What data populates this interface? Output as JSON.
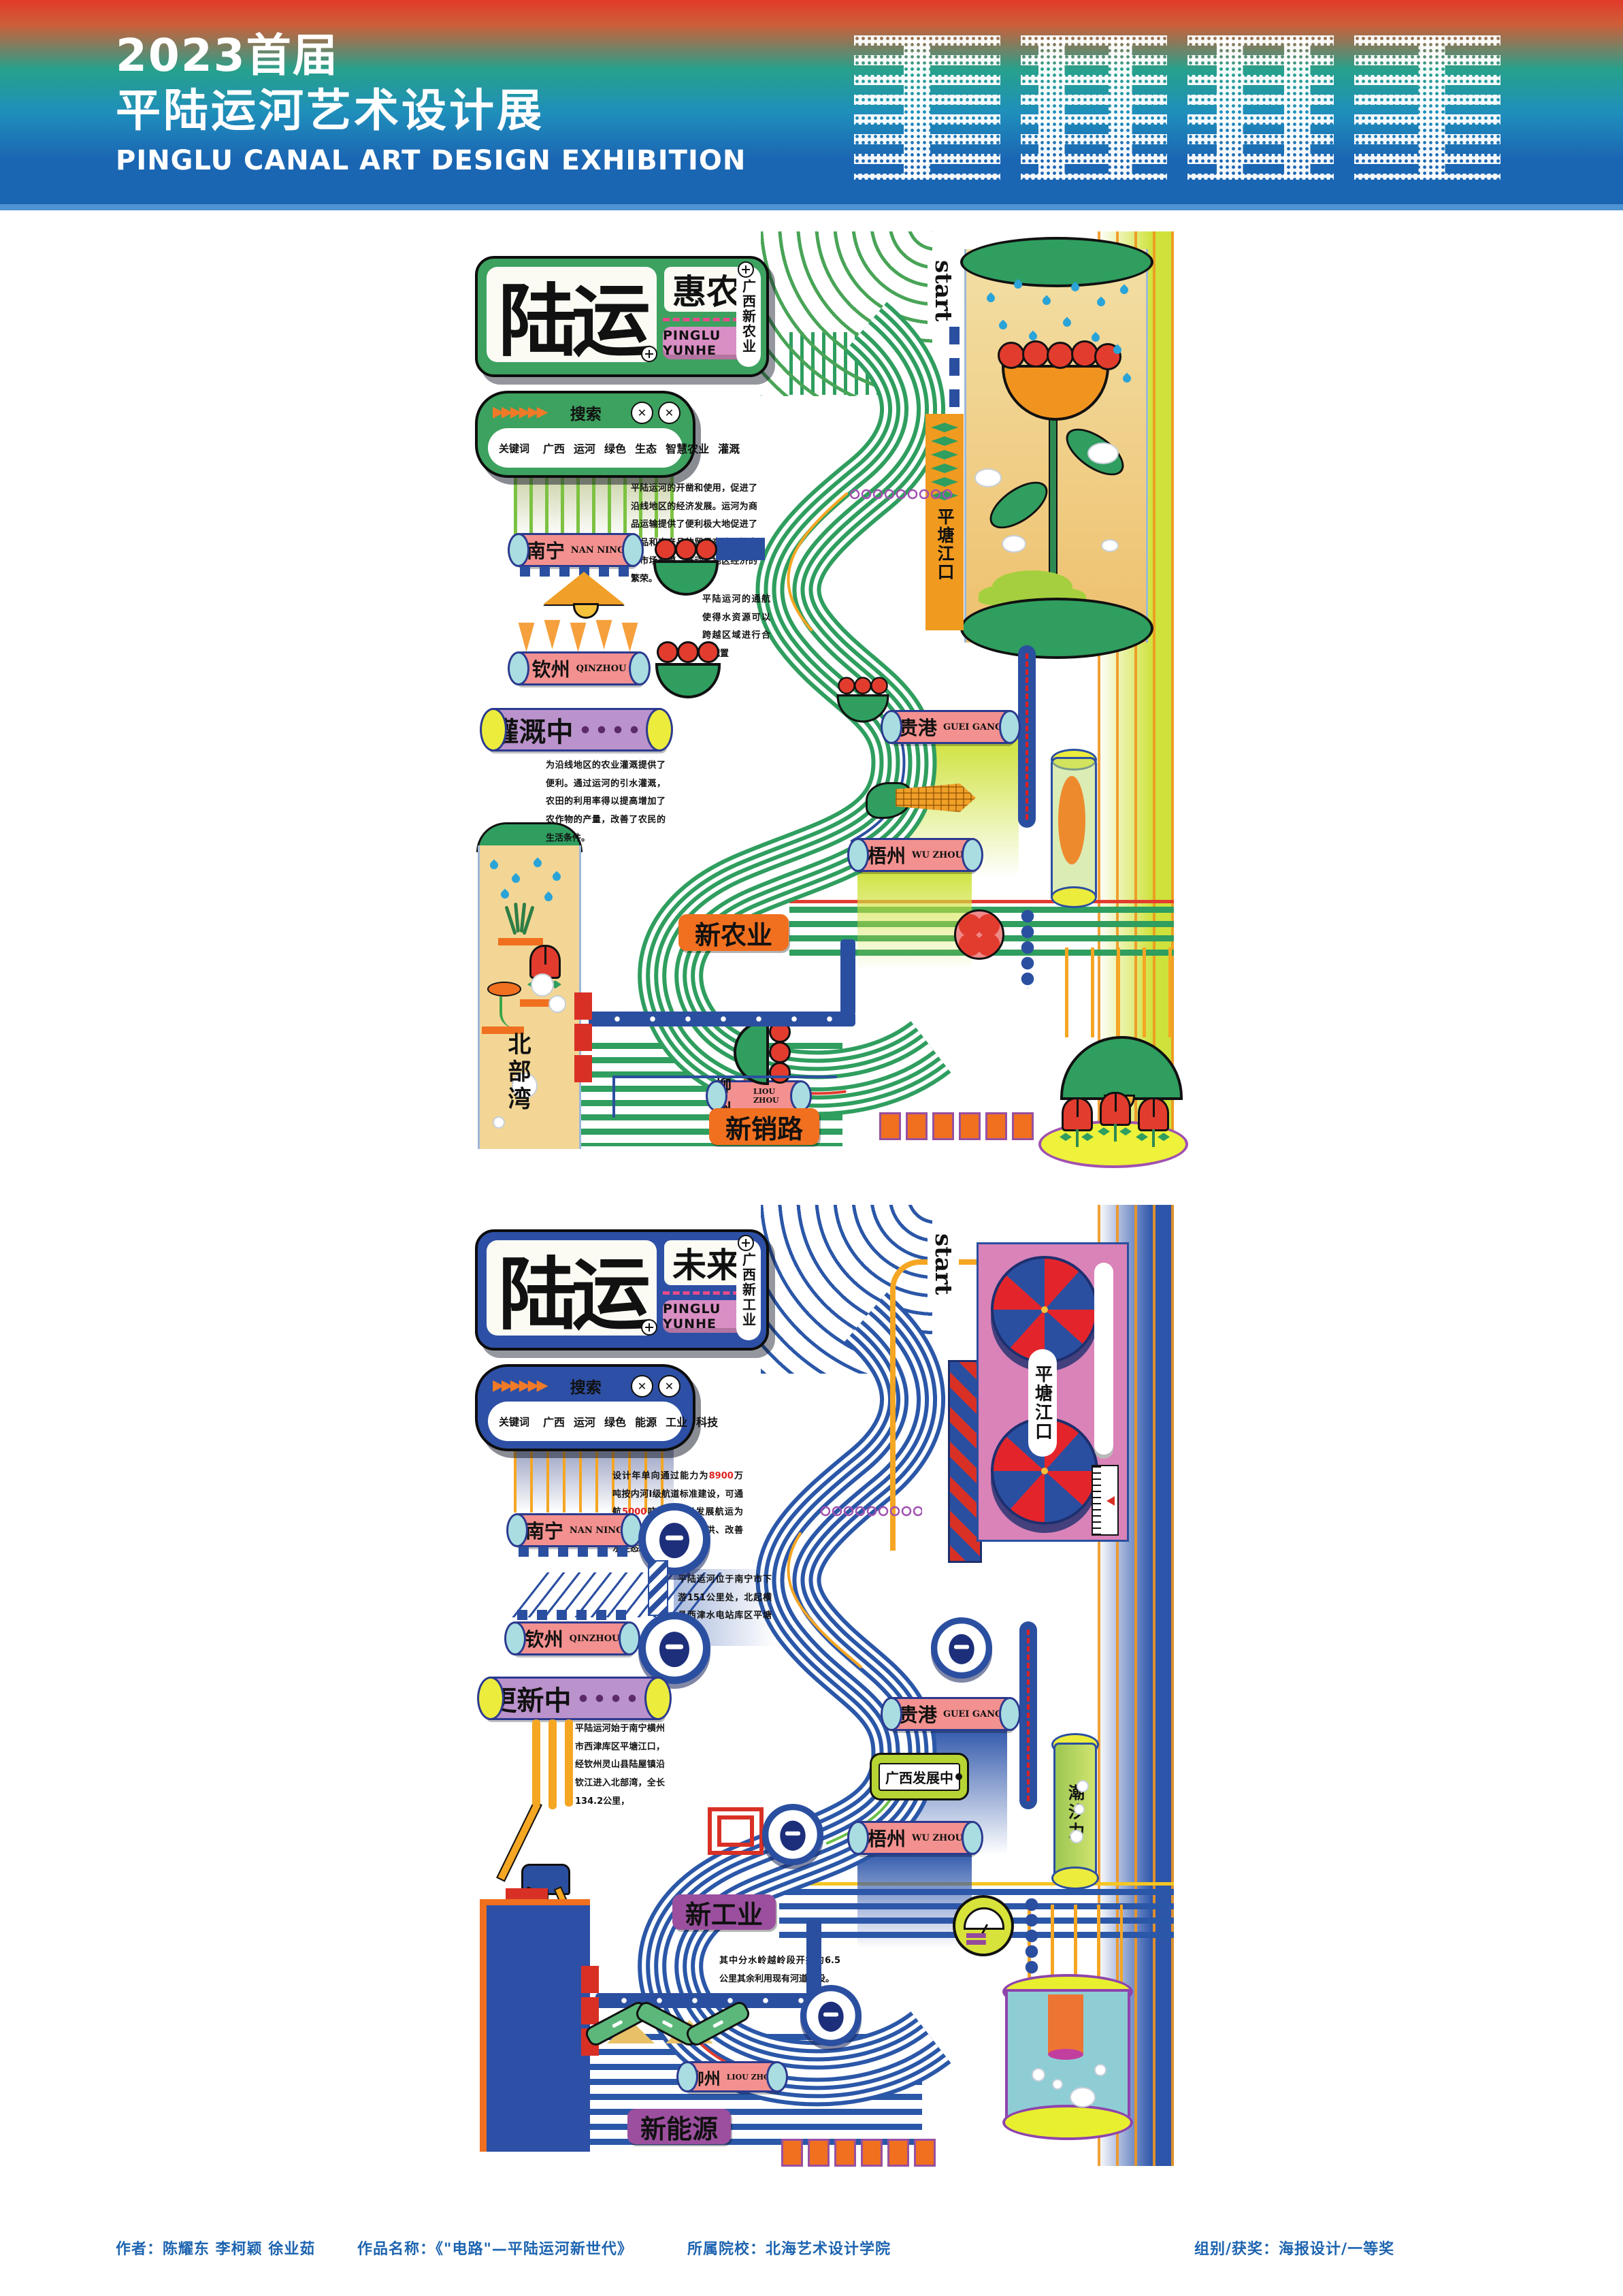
{
  "header": {
    "line1": "2023首届",
    "line2": "平陆运河艺术设计展",
    "line3": "PINGLU CANAL ART DESIGN EXHIBITION"
  },
  "footer": {
    "author": "作者：陈耀东 李柯颖 徐业茹",
    "work": "作品名称：《\"电路\"—平陆运河新世代》",
    "school": "所属院校：北海艺术设计学院",
    "award": "组别/获奖：海报设计/一等奖"
  },
  "poster1": {
    "brand": {
      "main": "陆运",
      "sub": "惠农",
      "pill": "PINGLU YUNHE",
      "vertical": "广西新农业"
    },
    "search": {
      "title": "搜索",
      "arrows": "▶▶▶▶▶▶",
      "close": "✕",
      "kw_label": "关键词",
      "keywords": [
        "广西",
        "运河",
        "绿色",
        "生态",
        "智慧农业",
        "灌溉"
      ]
    },
    "start_label": "start",
    "gate_label": "平塘江口",
    "status_label": "灌溉中",
    "bay_label": "北部湾",
    "tags": {
      "agriculture": "新农业",
      "sales": "新销路"
    },
    "cities": {
      "nanning": {
        "zh": "南宁",
        "en": "NAN NING"
      },
      "qinzhou": {
        "zh": "钦州",
        "en": "QINZHOU"
      },
      "guigang": {
        "zh": "贵港",
        "en": "GUEI GANG"
      },
      "wuzhou": {
        "zh": "梧州",
        "en": "WU ZHOU"
      },
      "liuzhou": {
        "zh": "柳州",
        "en": "LIOU ZHOU"
      }
    },
    "paragraphs": {
      "p1": "平陆运河的开凿和使用，促进了沿线地区的经济发展。运河为商品运输提供了便利极大地促进了商品和农产品的贸易交流，扩大了市场规模，推动了地区经济的繁荣。",
      "p2": "平陆运河的通航使得水资源可以跨越区域进行合理配置",
      "p3": "为沿线地区的农业灌溉提供了便利。通过运河的引水灌溉，农田的利用率得以提高增加了农作物的产量，改善了农民的生活条件。"
    }
  },
  "poster2": {
    "brand": {
      "main": "陆运",
      "sub": "未来",
      "pill": "PINGLU YUNHE",
      "vertical": "广西新工业"
    },
    "search": {
      "title": "搜索",
      "arrows": "▶▶▶▶▶▶",
      "close": "✕",
      "kw_label": "关键词",
      "keywords": [
        "广西",
        "运河",
        "绿色",
        "能源",
        "工业",
        "科技"
      ]
    },
    "start_label": "start",
    "gate_label": "平塘江口",
    "status_label": "更新中",
    "bay_label": "北部湾",
    "dev_label": "广西发展中",
    "tidal_label": "潮汐力",
    "tags": {
      "industry": "新工业",
      "energy": "新能源"
    },
    "cities": {
      "nanning": {
        "zh": "南宁",
        "en": "NAN NING"
      },
      "qinzhou": {
        "zh": "钦州",
        "en": "QINZHOU"
      },
      "guigang": {
        "zh": "贵港",
        "en": "GUEI GANG"
      },
      "wuzhou": {
        "zh": "梧州",
        "en": "WU ZHOU"
      },
      "liuzhou": {
        "zh": "柳州",
        "en": "LIOU ZHOU"
      }
    },
    "paragraphs": {
      "a1": "设计年单向通过能力为",
      "a_num1": "8900",
      "a2": "万吨按内河Ⅰ级航道标准建设，可通航",
      "a_num2": "5000",
      "a3": "吨级船舶以发展航运为主结合供水、灌溉、防洪、改善水生态环境等。",
      "b": "平陆运河位于南宁市下游151公里处，北起横县西津水电站库区平塘江口",
      "c": "平陆运河始于南宁横州市西津库区平塘江口，经钦州灵山县陆屋镇沿钦江进入北部湾，全长134.2公里，",
      "d": "其中分水岭越岭段开挖约6.5公里其余利用现有河道建设。"
    }
  },
  "colors": {
    "header_red": "#e23a2a",
    "header_teal": "#27a18c",
    "header_blue": "#1b66b3",
    "poster1_green": "#3da15f",
    "poster2_blue": "#2d4fa5",
    "canal_green": "#2f9e5f",
    "canal_blue": "#2b57a8",
    "city_pink": "#f2918f",
    "status_purple": "#ba92cc",
    "label_orange": "#f07020",
    "label_purple": "#9b4f9e",
    "brand_pill_pink": "#d98ec4"
  }
}
